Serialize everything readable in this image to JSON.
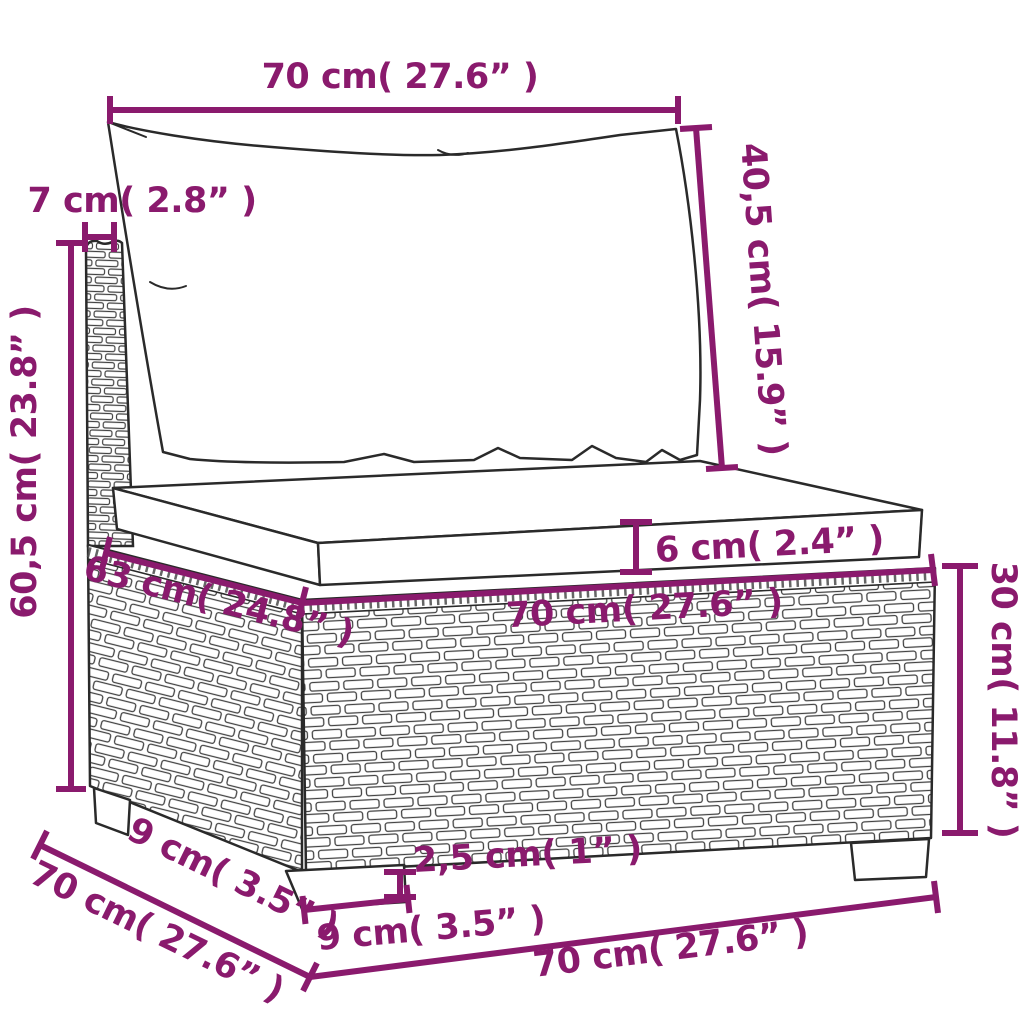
{
  "diagram": {
    "subject": "poly rattan sofa middle section with back cushion and seat cushion - dimension drawing",
    "accent_color": "#8a1a6d",
    "line_color": "#2a2a2a",
    "background": "#ffffff",
    "unit_system": "cm and inches",
    "dims": {
      "back_width": "70 cm( 27.6” )",
      "back_cushion_height": "40,5 cm( 15.9” )",
      "back_post_width": "7 cm( 2.8” )",
      "total_height": "60,5 cm( 23.8” )",
      "seat_cushion_thickness": "6 cm( 2.4” )",
      "seat_depth_top": "63 cm( 24.8” )",
      "seat_width_front": "70 cm( 27.6” )",
      "base_height": "30 cm( 11.8” )",
      "foot_height": "2,5 cm( 1” )",
      "foot_width": "9 cm( 3.5” )",
      "foot_depth": "9 cm( 3.5” )",
      "base_depth_bottom": "70 cm( 27.6” )",
      "base_width_bottom": "70 cm( 27.6” )"
    }
  }
}
